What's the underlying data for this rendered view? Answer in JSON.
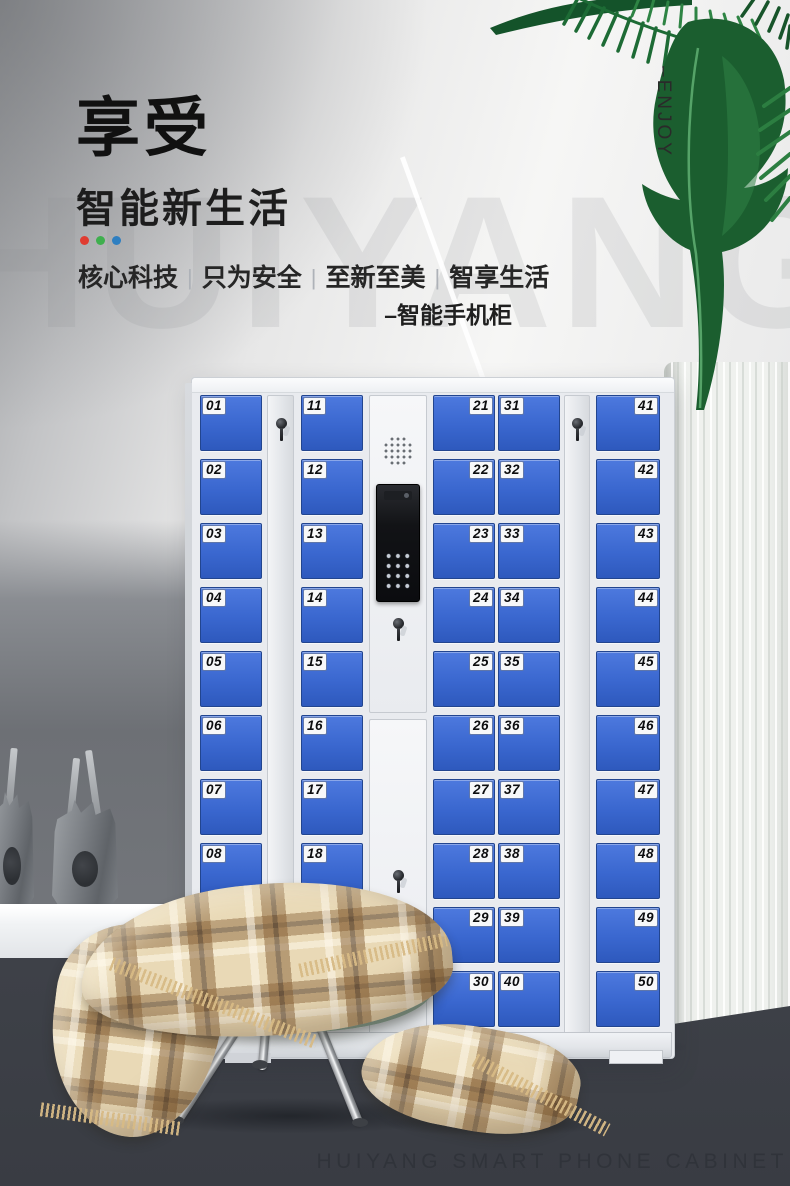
{
  "meta": {
    "watermark_bg": "HUIYANG",
    "enjoy_vertical": "–ENJOY",
    "brand_en": "HUIYANG SMART PHONE CABINET"
  },
  "hero": {
    "title_main": "享受",
    "title_sub": "智能新生活",
    "accent_dots": [
      "#e03c31",
      "#3faf4e",
      "#2e7fc1"
    ],
    "tagline_segments": [
      "核心科技",
      "只为安全",
      "至新至美",
      "智享生活"
    ],
    "tagline_separator": "|",
    "product_label": "–智能手机柜"
  },
  "cabinet": {
    "door_columns": [
      {
        "id": "01-10",
        "label_side": "left",
        "numbers": [
          "01",
          "02",
          "03",
          "04",
          "05",
          "06",
          "07",
          "08",
          "09",
          "10"
        ]
      },
      {
        "id": "11-20",
        "label_side": "left",
        "numbers": [
          "11",
          "12",
          "13",
          "14",
          "15",
          "16",
          "17",
          "18",
          "19",
          "20"
        ]
      },
      {
        "id": "21-30",
        "label_side": "right",
        "numbers": [
          "21",
          "22",
          "23",
          "24",
          "25",
          "26",
          "27",
          "28",
          "29",
          "30"
        ]
      },
      {
        "id": "31-40",
        "label_side": "left",
        "numbers": [
          "31",
          "32",
          "33",
          "34",
          "35",
          "36",
          "37",
          "38",
          "39",
          "40"
        ]
      },
      {
        "id": "41-50",
        "label_side": "right",
        "numbers": [
          "41",
          "42",
          "43",
          "44",
          "45",
          "46",
          "47",
          "48",
          "49",
          "50"
        ]
      }
    ],
    "icons": {
      "speaker": "speaker-grille-icon",
      "camera": "intercom-camera-icon",
      "keypad": "keypad-icon",
      "lock": "key-lock-icon"
    }
  },
  "colors": {
    "door_blue": "#3a67cf",
    "cabinet_body": "#e9ebef",
    "leaf_green": "#1b5e2f",
    "curtain": "#eff1ee",
    "floor_dark": "#45484f",
    "blanket_base": "#e9d9b6",
    "cushion_green": "#b5cab9"
  }
}
